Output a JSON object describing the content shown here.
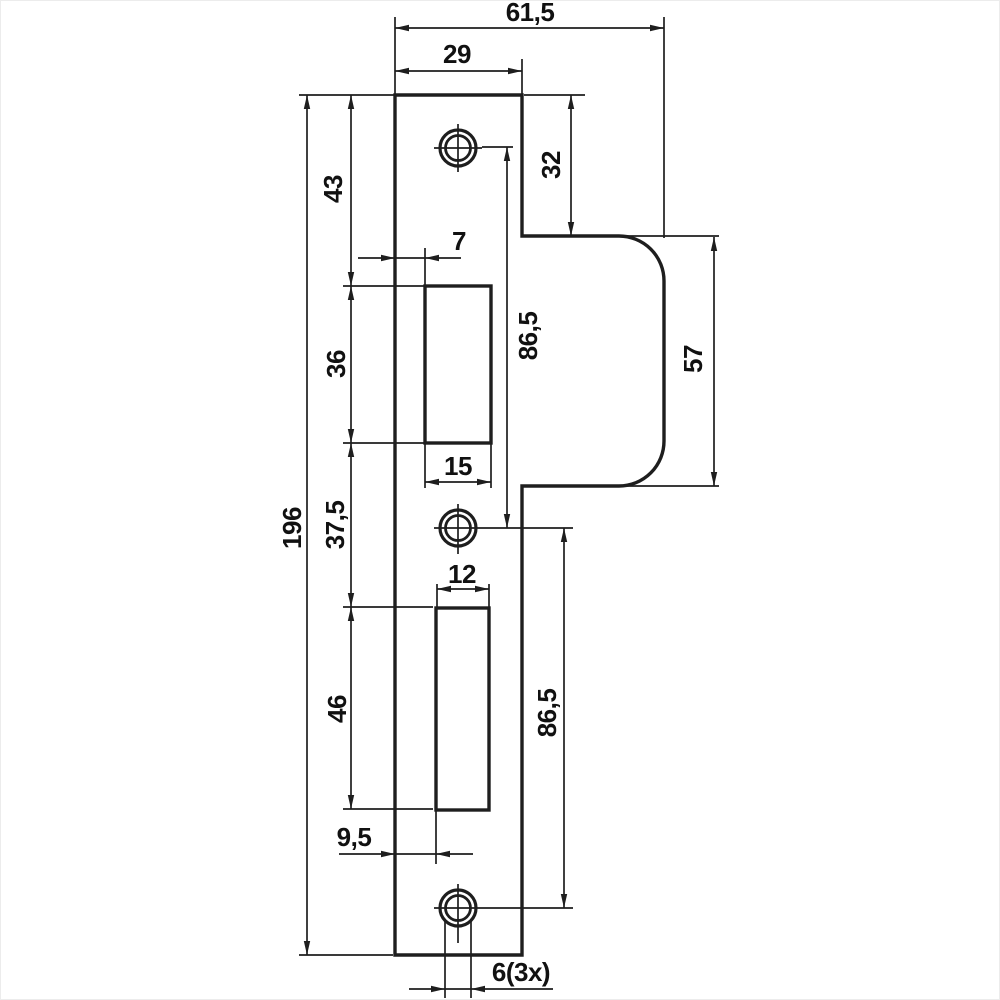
{
  "figure": {
    "kind": "technical dimension drawing",
    "subject": "lock strike plate, front view",
    "background_color": "#ffffff",
    "stroke_color": "#1e1e1e",
    "text_color": "#111111"
  },
  "dims": {
    "total_width": "61,5",
    "plate_width": "29",
    "lip_top_offset": "32",
    "top_to_latch_cutout": "43",
    "latch_cutout_left_offset": "7",
    "latch_cutout_height": "36",
    "upper_hole_spacing": "86,5",
    "lip_height": "57",
    "latch_cutout_width": "15",
    "cutout_gap": "37,5",
    "plate_length": "196",
    "bolt_cutout_width": "12",
    "bolt_cutout_height": "46",
    "lower_hole_spacing": "86,5",
    "bolt_cutout_left_offset": "9,5",
    "hole_diameter": "6(3x)"
  }
}
